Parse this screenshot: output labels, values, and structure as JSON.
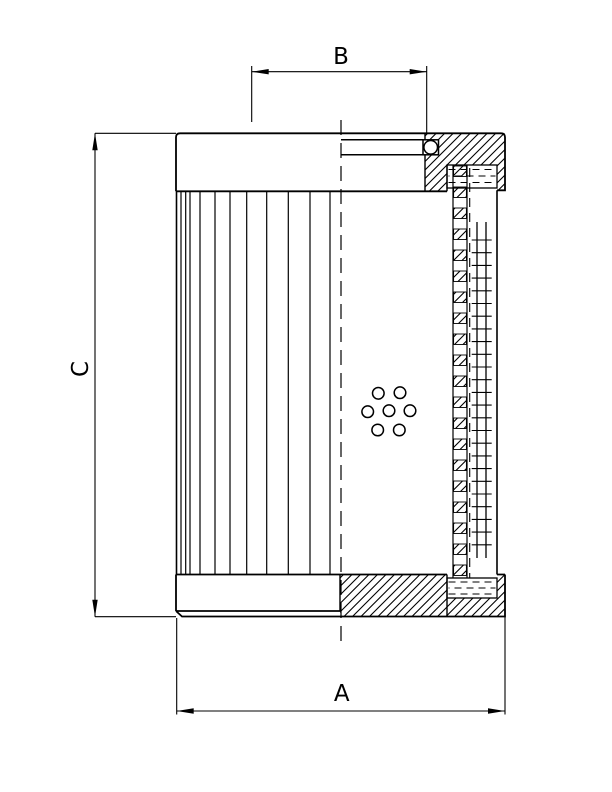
{
  "page": {
    "background_color": "#ffffff",
    "line_color": "#000000"
  },
  "drawing": {
    "kind": "filter-element-section-drawing",
    "dimension_labels": {
      "a": "A",
      "b": "B",
      "c": "C"
    }
  }
}
